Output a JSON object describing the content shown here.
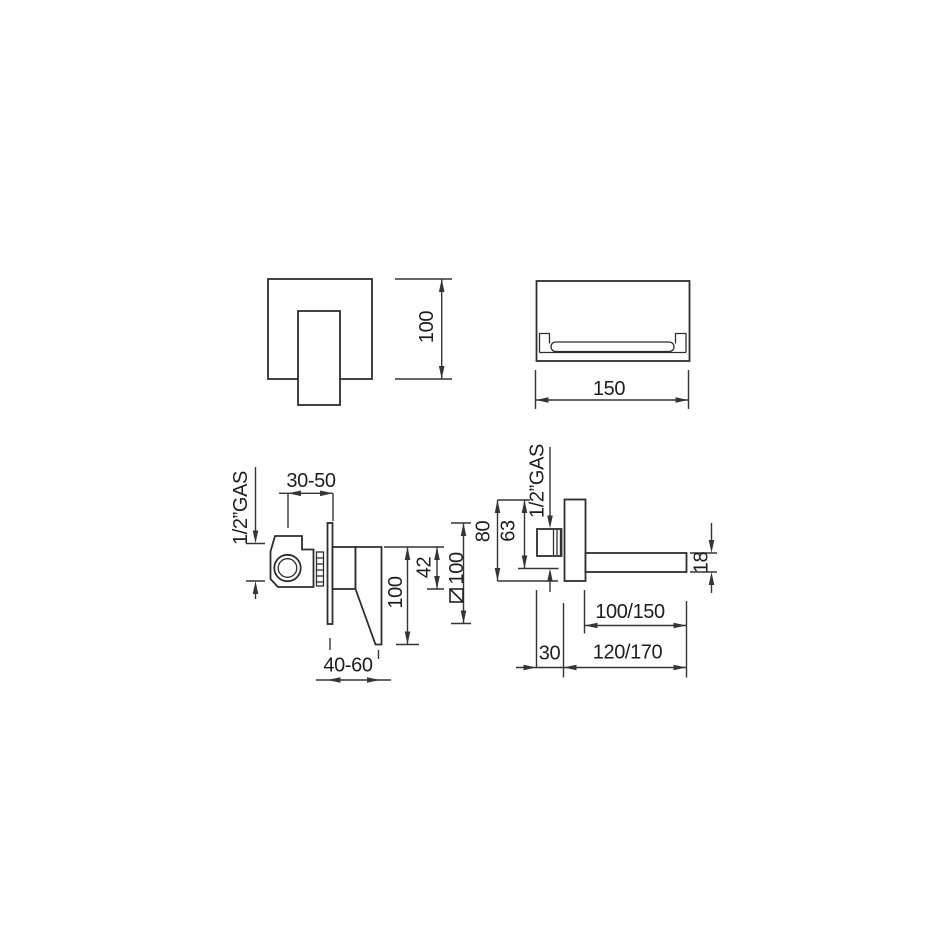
{
  "drawing": {
    "type": "technical-dimension-drawing",
    "subject": "wall-mounted basin mixer with concealed valve and waterfall spout",
    "background_color": "#ffffff",
    "line_color": "#2e2e2e",
    "views": {
      "plate_front": {
        "name": "control-plate-front-view",
        "height_dim": "100"
      },
      "spout_front": {
        "name": "spout-front-view",
        "width_dim": "150"
      },
      "mixer_side": {
        "name": "mixer-valve-side-view",
        "thread_label": "1/2”GAS",
        "recess_depth_range": "30-50",
        "handle_depth_range": "40-60",
        "cartridge_height": "42",
        "handle_length": "100",
        "plate_size": {
          "symbol": "square",
          "value": "100"
        }
      },
      "spout_side": {
        "name": "spout-side-view",
        "thread_label": "1/2”GAS",
        "plate_height": "80",
        "inlet_offset": "63",
        "spout_thickness": "18",
        "spout_reach": "100/150",
        "total_reach": "120/170",
        "inlet_depth": "30"
      }
    }
  }
}
